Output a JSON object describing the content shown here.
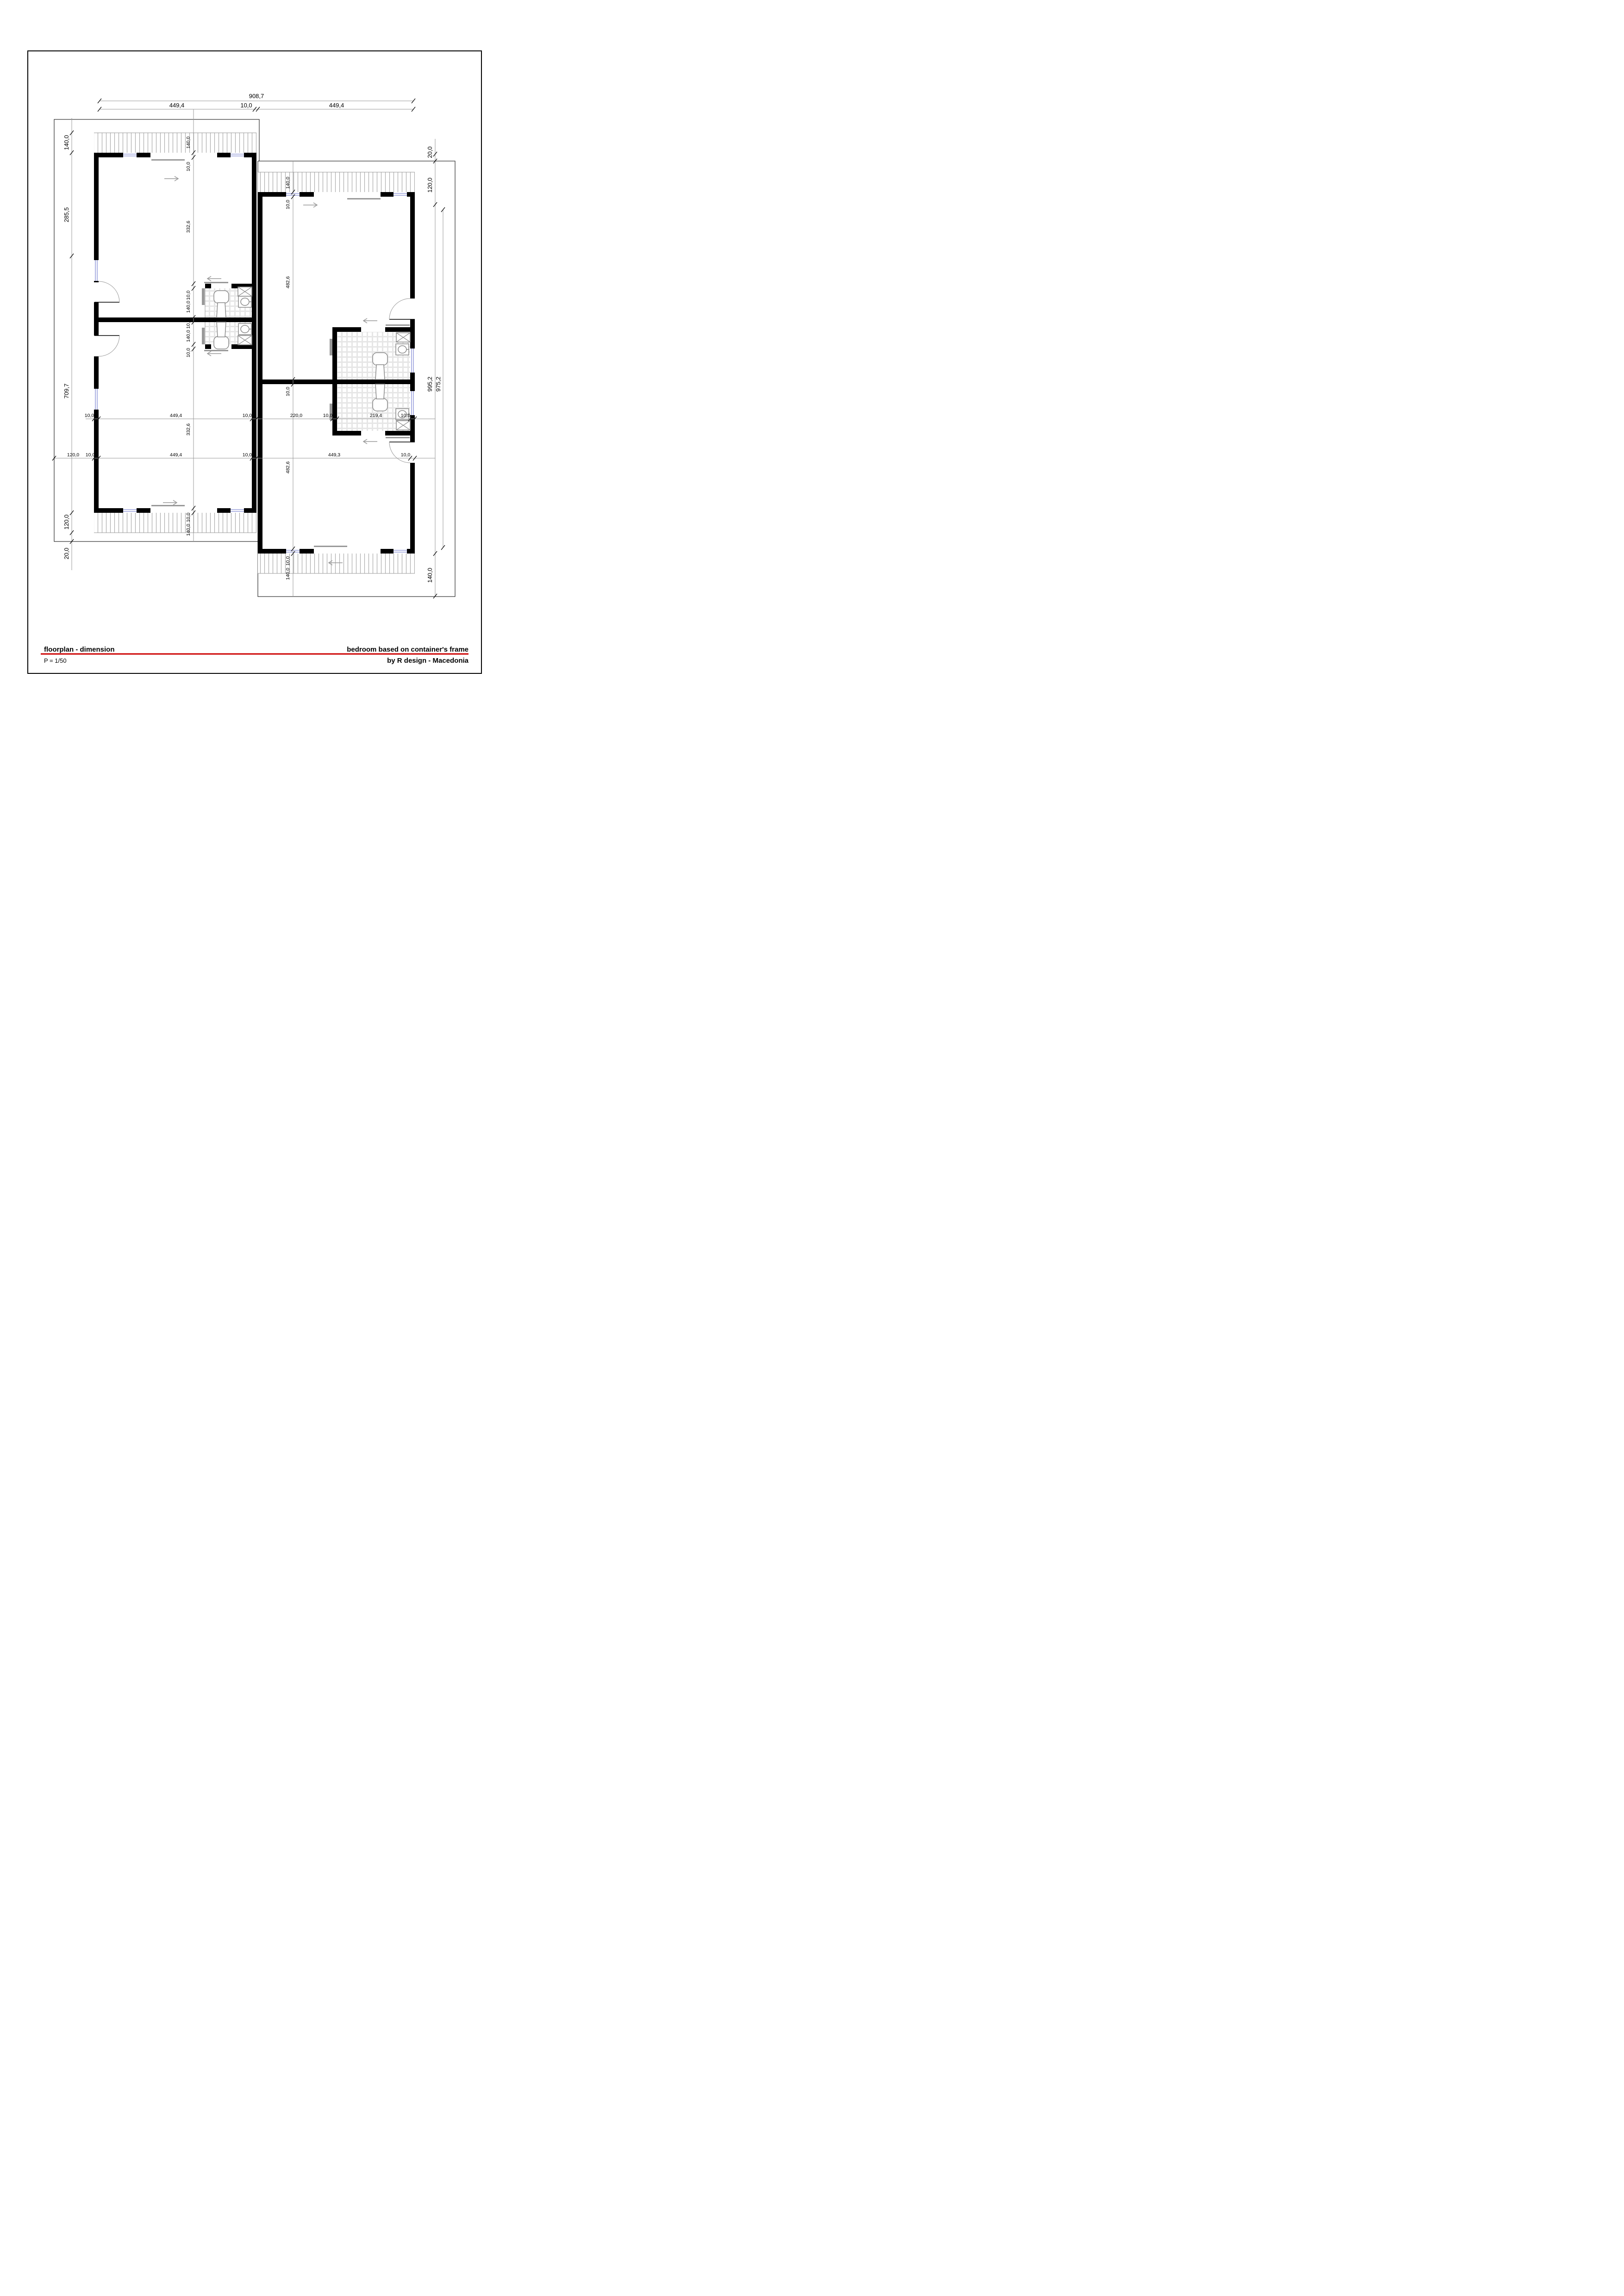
{
  "title_block": {
    "left_title": "floorplan - dimension",
    "scale": "P = 1/50",
    "right_title": "bedroom based on container's frame",
    "credit": "by R design - Macedonia"
  },
  "colors": {
    "accent_red": "#cc0000",
    "wall_black": "#000000",
    "dimension_gray": "#999999",
    "window_glass": "#9aa0dc",
    "tile_grout": "#e6e6e6",
    "deck_hatch": "#aaaaaa"
  },
  "dims": {
    "top_total": "908,7",
    "top_row": [
      "449,4",
      "10,0",
      "449,4"
    ],
    "left_col": [
      "140,0",
      "285,5",
      "709,7",
      "120,0",
      "20,0"
    ],
    "right_col": [
      "20,0",
      "120,0",
      "995,2",
      "140,0"
    ],
    "right_outer": "975,2",
    "mid_row": [
      "10,0",
      "449,4",
      "10,0",
      "220,0",
      "10,0",
      "219,4",
      "10,0"
    ],
    "lower_row": [
      "120,0",
      "10,0",
      "449,4",
      "10,0",
      "449,3",
      "10,0"
    ],
    "unit_a_col": [
      "140,0",
      "10,0",
      "332,6",
      "10,0",
      "140,0",
      "10,0",
      "140,0",
      "10,0",
      "332,6",
      "10,0",
      "140,0"
    ],
    "unit_b_col": [
      "140,0",
      "10,0",
      "482,6",
      "10,0",
      "482,6",
      "10,0",
      "140,0"
    ]
  }
}
